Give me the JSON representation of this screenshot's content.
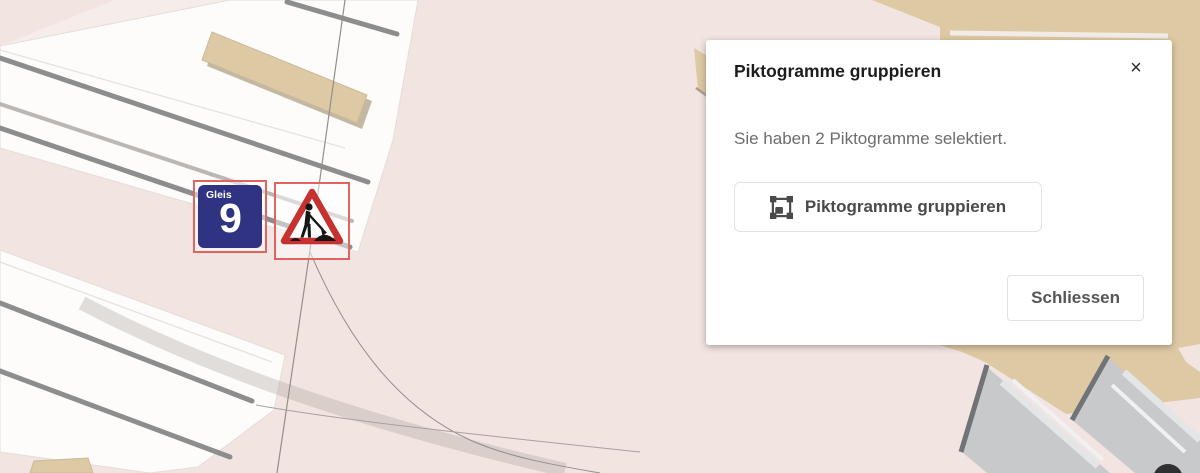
{
  "dialog": {
    "title": "Piktogramme gruppieren",
    "close_icon": "×",
    "message": "Sie haben 2 Piktogramme selektiert.",
    "group_button": {
      "label": "Piktogramme gruppieren",
      "icon": "group-objects-icon"
    },
    "close_button": {
      "label": "Schliessen"
    }
  },
  "map": {
    "pictograms": [
      {
        "name": "track-9-sign",
        "label": "Gleis",
        "number": "9",
        "selected": true
      },
      {
        "name": "construction-warning-sign",
        "selected": true
      }
    ],
    "colors": {
      "background": "#f2e4e1",
      "platform_white": "#fdfcfb",
      "track_line_gray": "#8d8d8d",
      "building_tan": "#ddc9a3",
      "ramp_gray": "#c7c9cb",
      "selection_red": "#df6462",
      "sign_blue": "#2f3382",
      "sign_red": "#c5322f"
    }
  }
}
